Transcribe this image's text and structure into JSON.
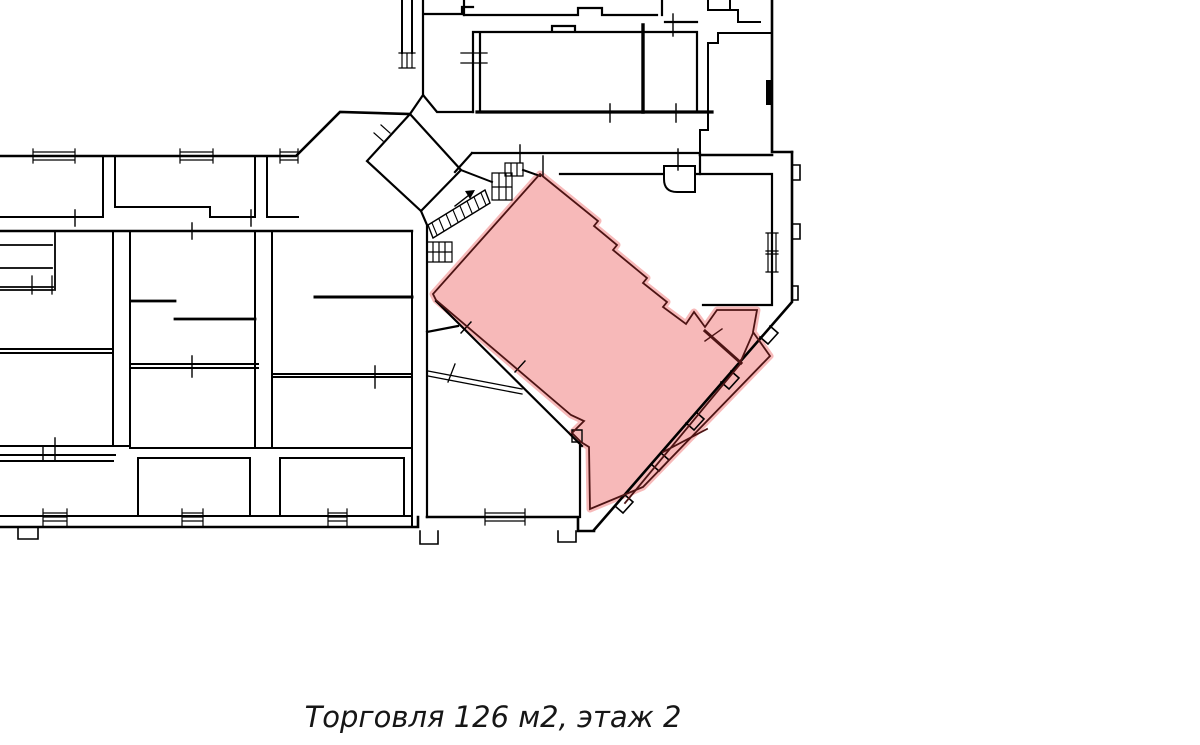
{
  "page": {
    "background_color": "#ffffff"
  },
  "caption": {
    "text": "Торговля 126 м2, этаж 2"
  },
  "unit": {
    "usage": "Торговля",
    "area": "126 м2",
    "floor": "этаж 2"
  },
  "plan": {
    "wall_color": "#000000",
    "highlight": {
      "fill": "#f7b9b9",
      "outline": "#4d1414"
    }
  }
}
